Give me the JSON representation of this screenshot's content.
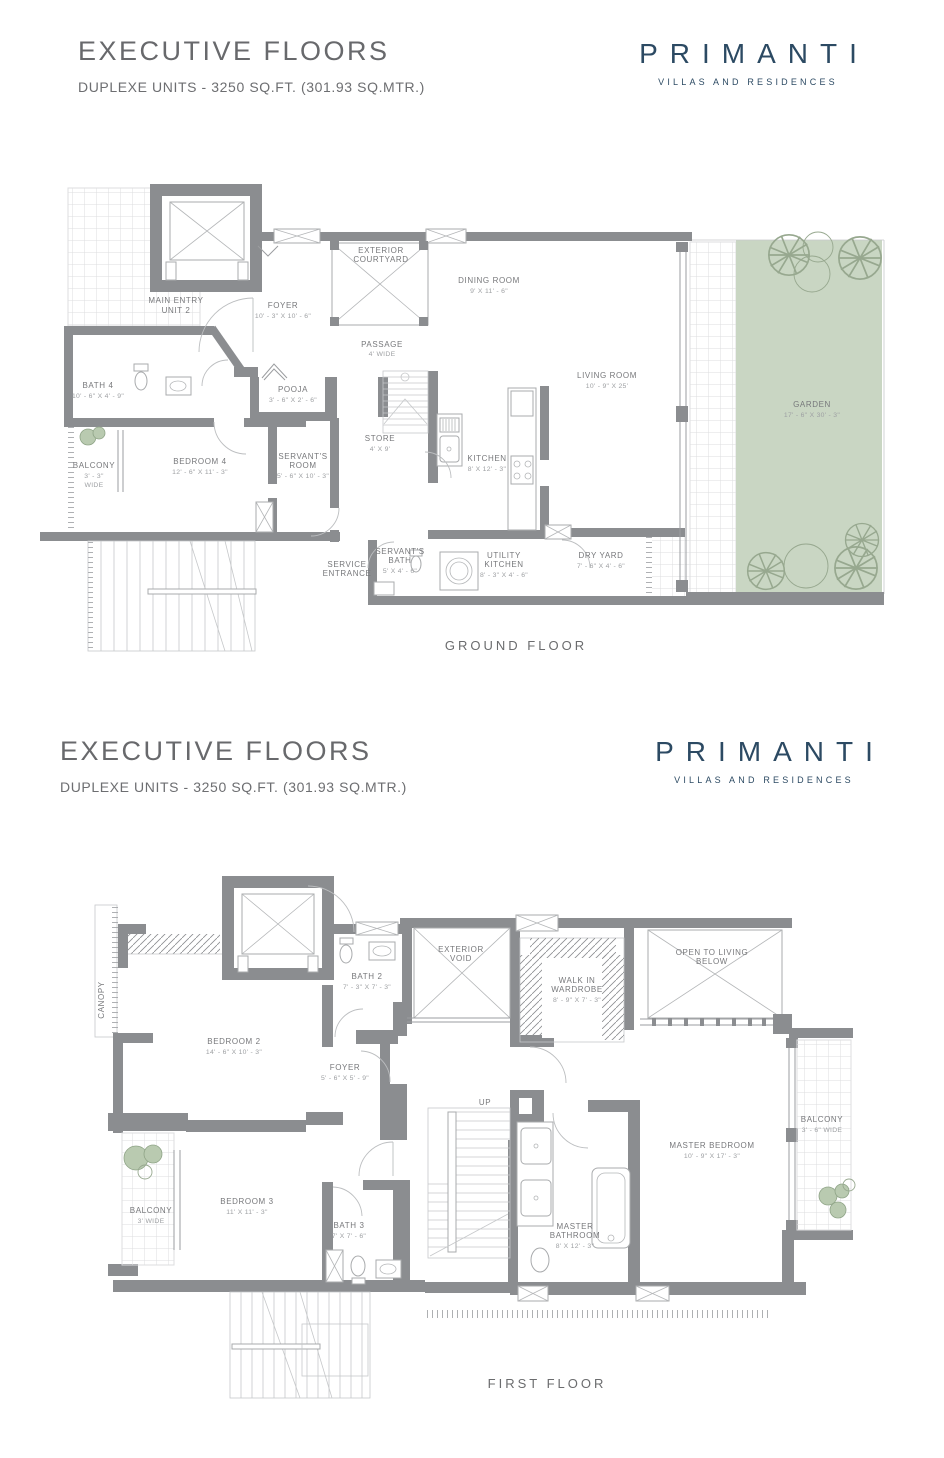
{
  "header": {
    "title": "EXECUTIVE FLOORS",
    "subtitle": "DUPLEXE UNITS - 3250 SQ.FT. (301.93 SQ.MTR.)",
    "brand": "PRIMANTI",
    "tagline": "VILLAS AND RESIDENCES"
  },
  "colors": {
    "brand_blue": "#2c4a63",
    "wall_gray": "#8b8d90",
    "garden_green": "#c9d6c3",
    "heading_gray": "#68696c",
    "label_gray": "#77787b"
  },
  "ground": {
    "caption": "GROUND FLOOR",
    "rooms": {
      "main_entry": {
        "name": "MAIN ENTRY",
        "name2": "UNIT 2"
      },
      "foyer": {
        "name": "FOYER",
        "dims": "10' - 3\" X 10' - 6\""
      },
      "courtyard": {
        "name": "EXTERIOR",
        "name2": "COURTYARD"
      },
      "dining": {
        "name": "DINING ROOM",
        "dims": "9' X 11' - 6\""
      },
      "passage": {
        "name": "PASSAGE",
        "dims": "4' WIDE"
      },
      "living": {
        "name": "LIVING ROOM",
        "dims": "10' - 9\" X 25'"
      },
      "garden": {
        "name": "GARDEN",
        "dims": "17' - 6\" X 30' - 3\""
      },
      "bath4": {
        "name": "BATH 4",
        "dims": "10' - 6\" X 4' - 9\""
      },
      "pooja": {
        "name": "POOJA",
        "dims": "3' - 6\" X 2' - 6\""
      },
      "store": {
        "name": "STORE",
        "dims": "4' X 9'"
      },
      "kitchen": {
        "name": "KITCHEN",
        "dims": "8' X 12' - 3\""
      },
      "balcony": {
        "name": "BALCONY",
        "dims": "3' - 3\"",
        "dims2": "WIDE"
      },
      "bedroom4": {
        "name": "BEDROOM 4",
        "dims": "12' - 6\" X 11' - 3\""
      },
      "servants_room": {
        "name": "SERVANT'S",
        "name2": "ROOM",
        "dims": "5' - 6\" X 10' - 3\""
      },
      "servants_bath": {
        "name": "SERVANT'S",
        "name2": "BATH",
        "dims": "5' X 4' - 6\""
      },
      "service": {
        "name": "SERVICE",
        "name2": "ENTRANCE"
      },
      "utility": {
        "name": "UTILITY",
        "name2": "KITCHEN",
        "dims": "8' - 3\" X 4' - 6\""
      },
      "dry_yard": {
        "name": "DRY YARD",
        "dims": "7' - 6\" X 4' - 6\""
      }
    }
  },
  "first": {
    "caption": "FIRST FLOOR",
    "rooms": {
      "canopy": {
        "name": "CANOPY"
      },
      "bedroom2": {
        "name": "BEDROOM 2",
        "dims": "14' - 6\" X 10' - 3\""
      },
      "bath2": {
        "name": "BATH 2",
        "dims": "7' - 3\" X 7' - 3\""
      },
      "void": {
        "name": "EXTERIOR",
        "name2": "VOID"
      },
      "wardrobe": {
        "name": "WALK IN",
        "name2": "WARDROBE",
        "dims": "8' - 9\" X 7' - 3\""
      },
      "open_living": {
        "name": "OPEN TO LIVING",
        "name2": "BELOW"
      },
      "foyer": {
        "name": "FOYER",
        "dims": "5' - 6\" X 5' - 9\""
      },
      "up": {
        "name": "UP"
      },
      "master_bed": {
        "name": "MASTER BEDROOM",
        "dims": "10' - 9\" X 17' - 3\""
      },
      "balcony_r": {
        "name": "BALCONY",
        "dims": "3' - 6\" WIDE"
      },
      "bedroom3": {
        "name": "BEDROOM 3",
        "dims": "11' X 11' - 3\""
      },
      "balcony_l": {
        "name": "BALCONY",
        "dims": "3' WIDE"
      },
      "bath3": {
        "name": "BATH 3",
        "dims": "7' X 7' - 6\""
      },
      "master_bath": {
        "name": "MASTER",
        "name2": "BATHROOM",
        "dims": "8' X 12' - 3\""
      }
    }
  }
}
